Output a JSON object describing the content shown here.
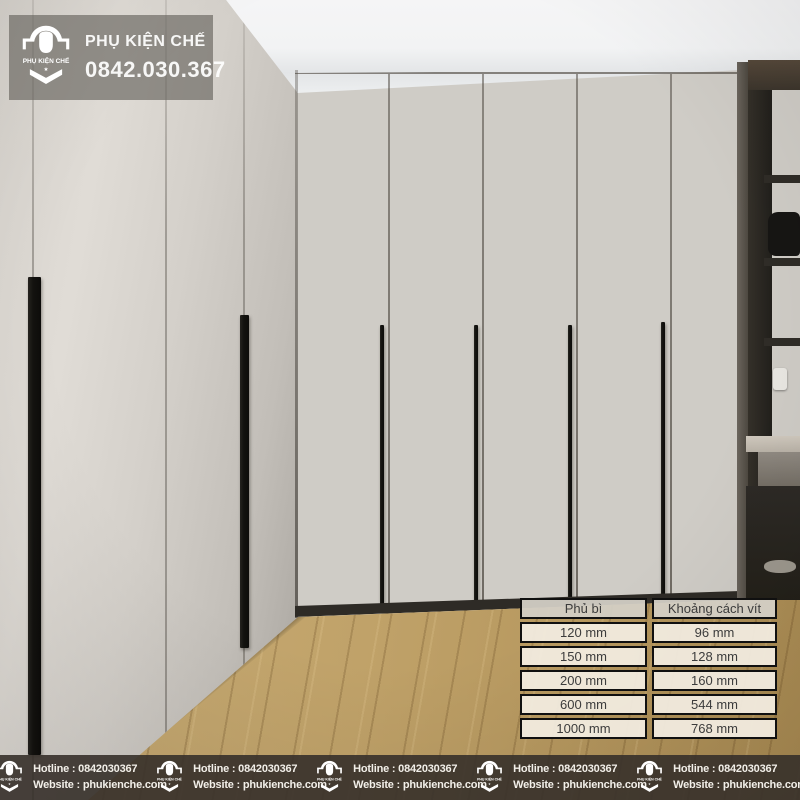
{
  "brand": {
    "name": "PHỤ KIỆN CHẾ",
    "logo_text": "PHỤ KIỆN CHẾ",
    "logo_star": "★"
  },
  "watermark": {
    "title": "PHỤ KIỆN CHẾ",
    "phone": "0842.030.367"
  },
  "spec_table": {
    "columns": [
      {
        "header": "Phủ bì",
        "values": [
          "120 mm",
          "150 mm",
          "200 mm",
          "600 mm",
          "1000 mm"
        ]
      },
      {
        "header": "Khoảng cách vít",
        "values": [
          "96 mm",
          "128 mm",
          "160 mm",
          "544 mm",
          "768 mm"
        ]
      }
    ]
  },
  "footer": {
    "items": [
      {
        "hotline": "Hotline : 0842030367",
        "website": "Website : phukienche.com"
      },
      {
        "hotline": "Hotline : 0842030367",
        "website": "Website : phukienche.com"
      },
      {
        "hotline": "Hotline : 0842030367",
        "website": "Website : phukienche.com"
      },
      {
        "hotline": "Hotline : 0842030367",
        "website": "Website : phukienche.com"
      },
      {
        "hotline": "Hotline : 0842030367",
        "website": "Website : phukienche.com"
      }
    ]
  },
  "colors": {
    "footer_bg": "#36302a",
    "watermark_bg": "#6a6762",
    "table_cell_bg": "#f2ece0",
    "table_border": "#101010",
    "handle_black": "#13120f",
    "floor_wood": "#c0a269",
    "back_door_taupe": "#a29a8e",
    "left_door_gray": "#d4d0ca"
  }
}
